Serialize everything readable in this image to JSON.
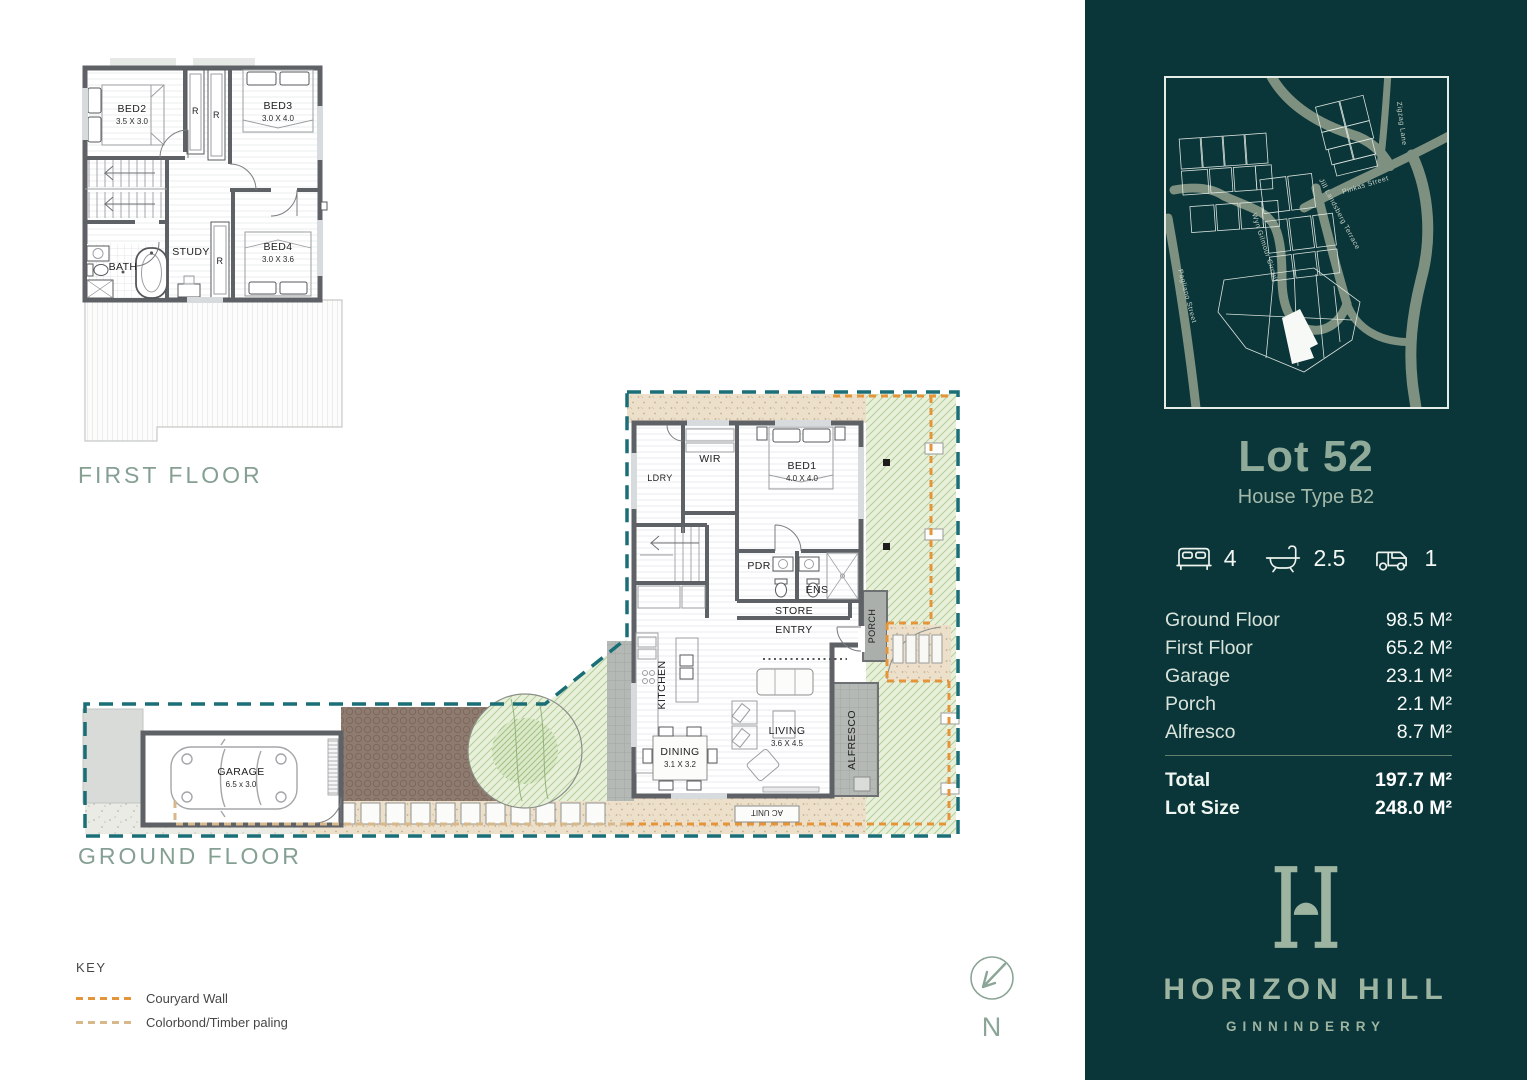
{
  "colors": {
    "sidebar_bg": "#0A3539",
    "accent_sage": "#8FAA99",
    "brand_sage": "#9DB4A1",
    "boundary_teal": "#1A6E76",
    "courtyard_orange": "#E59539",
    "paling_tan": "#D7B88A",
    "grass_green": "#E8F0DA"
  },
  "first_floor": {
    "label": "FIRST FLOOR",
    "rooms": {
      "bed2": {
        "name": "BED2",
        "dims": "3.5 X 3.0"
      },
      "bed3": {
        "name": "BED3",
        "dims": "3.0 X 4.0"
      },
      "bed4": {
        "name": "BED4",
        "dims": "3.0 X 3.6"
      },
      "bath": "BATH",
      "study": "STUDY",
      "robe": "R"
    }
  },
  "ground_floor": {
    "label": "GROUND FLOOR",
    "rooms": {
      "ldry": "LDRY",
      "wir": "WIR",
      "bed1": {
        "name": "BED1",
        "dims": "4.0 X 4.0"
      },
      "pdr": "PDR",
      "ens": "ENS",
      "store": "STORE",
      "entry": "ENTRY",
      "porch": "PORCH",
      "kitchen": "KITCHEN",
      "dining": {
        "name": "DINING",
        "dims": "3.1 X 3.2"
      },
      "living": {
        "name": "LIVING",
        "dims": "3.6 X 4.5"
      },
      "alfresco": "ALFRESCO",
      "garage": {
        "name": "GARAGE",
        "dims": "6.5 x 3.0"
      },
      "ac": "AC UNIT"
    }
  },
  "key": {
    "title": "KEY",
    "items": [
      {
        "label": "Couryard Wall",
        "color": "#E59539"
      },
      {
        "label": "Colorbond/Timber paling",
        "color": "#D7B88A"
      }
    ]
  },
  "north_label": "N",
  "sidebar": {
    "map": {
      "streets": [
        {
          "name": "Pagliano Street"
        },
        {
          "name": "Wyn Gilmour Circuit"
        },
        {
          "name": "Jill Landsberg Terrace"
        },
        {
          "name": "Pinkas Street"
        },
        {
          "name": "Zigzag Lane"
        }
      ]
    },
    "lot_title": "Lot 52",
    "house_type": "House Type B2",
    "features": {
      "beds": "4",
      "baths": "2.5",
      "cars": "1"
    },
    "areas": [
      {
        "label": "Ground Floor",
        "value": "98.5 M²"
      },
      {
        "label": "First Floor",
        "value": "65.2 M²"
      },
      {
        "label": "Garage",
        "value": "23.1 M²"
      },
      {
        "label": "Porch",
        "value": "2.1 M²"
      },
      {
        "label": "Alfresco",
        "value": "8.7 M²"
      }
    ],
    "totals": [
      {
        "label": "Total",
        "value": "197.7 M²"
      },
      {
        "label": "Lot Size",
        "value": "248.0 M²"
      }
    ],
    "brand": {
      "name": "HORIZON HILL",
      "sub": "GINNINDERRY"
    }
  }
}
